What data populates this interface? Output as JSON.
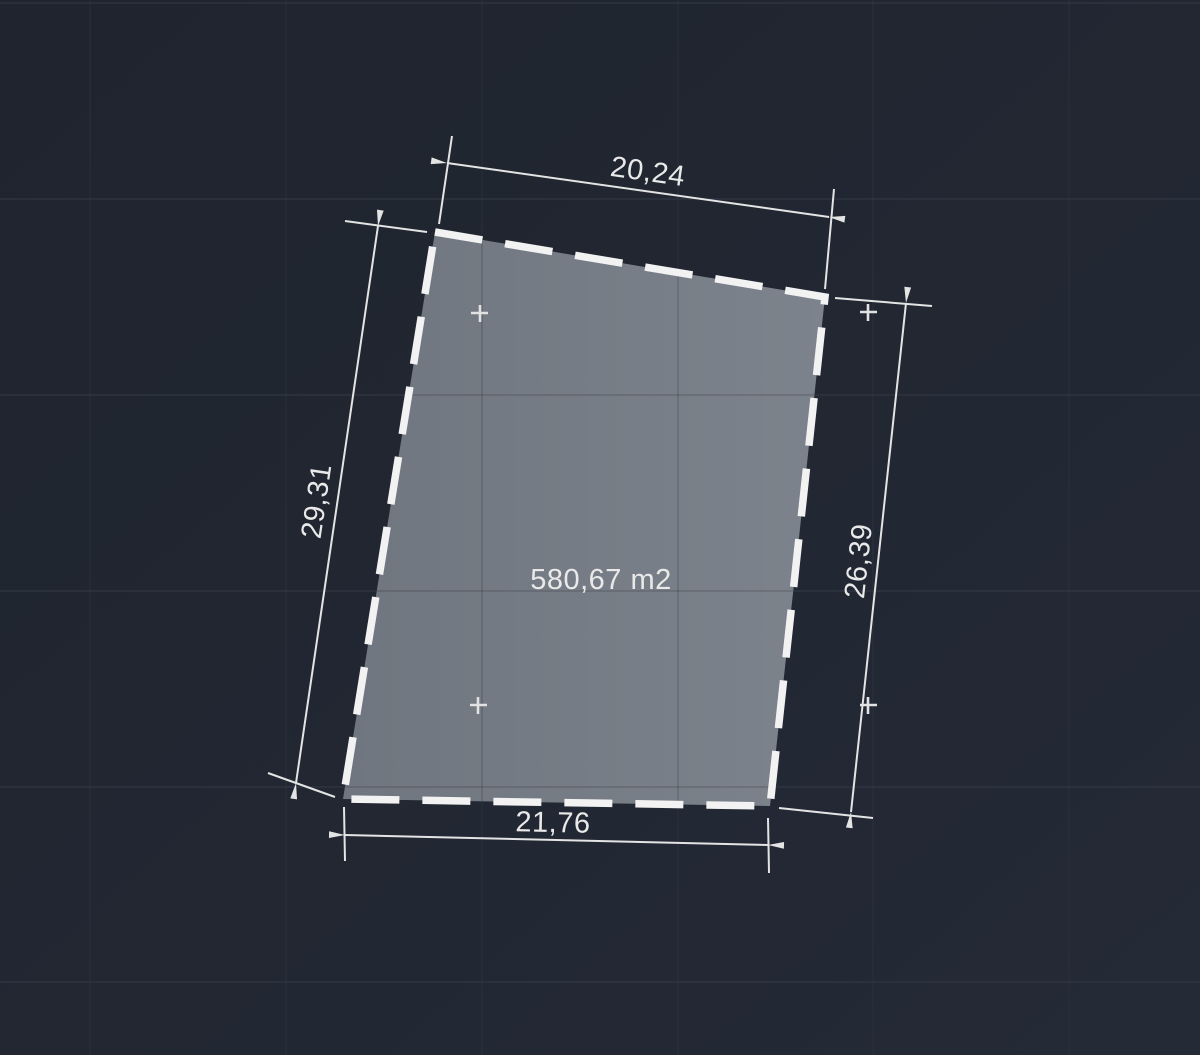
{
  "viewport": {
    "application": "cad-drawing-canvas"
  },
  "theme": {
    "bg_top": "#1f242e",
    "bg_bottom": "#242a36",
    "grid_vertical": "#2a303c",
    "grid_horizontal": "#333a47",
    "grid_on_parcel": "rgba(0,0,0,0.16)",
    "parcel_fill_left": "#70767f",
    "parcel_fill_right": "#7d838c",
    "parcel_outline": "#f2f2f2",
    "dim_color": "#e4e4e4",
    "text_color": "#e9e9e9",
    "marker_color": "#e2e2e2"
  },
  "parcel": {
    "area_label": "580,67 m2"
  },
  "dimensions": {
    "top": {
      "label": "20,24"
    },
    "left": {
      "label": "29,31"
    },
    "right": {
      "label": "26,39"
    },
    "bottom": {
      "label": "21,76"
    }
  }
}
